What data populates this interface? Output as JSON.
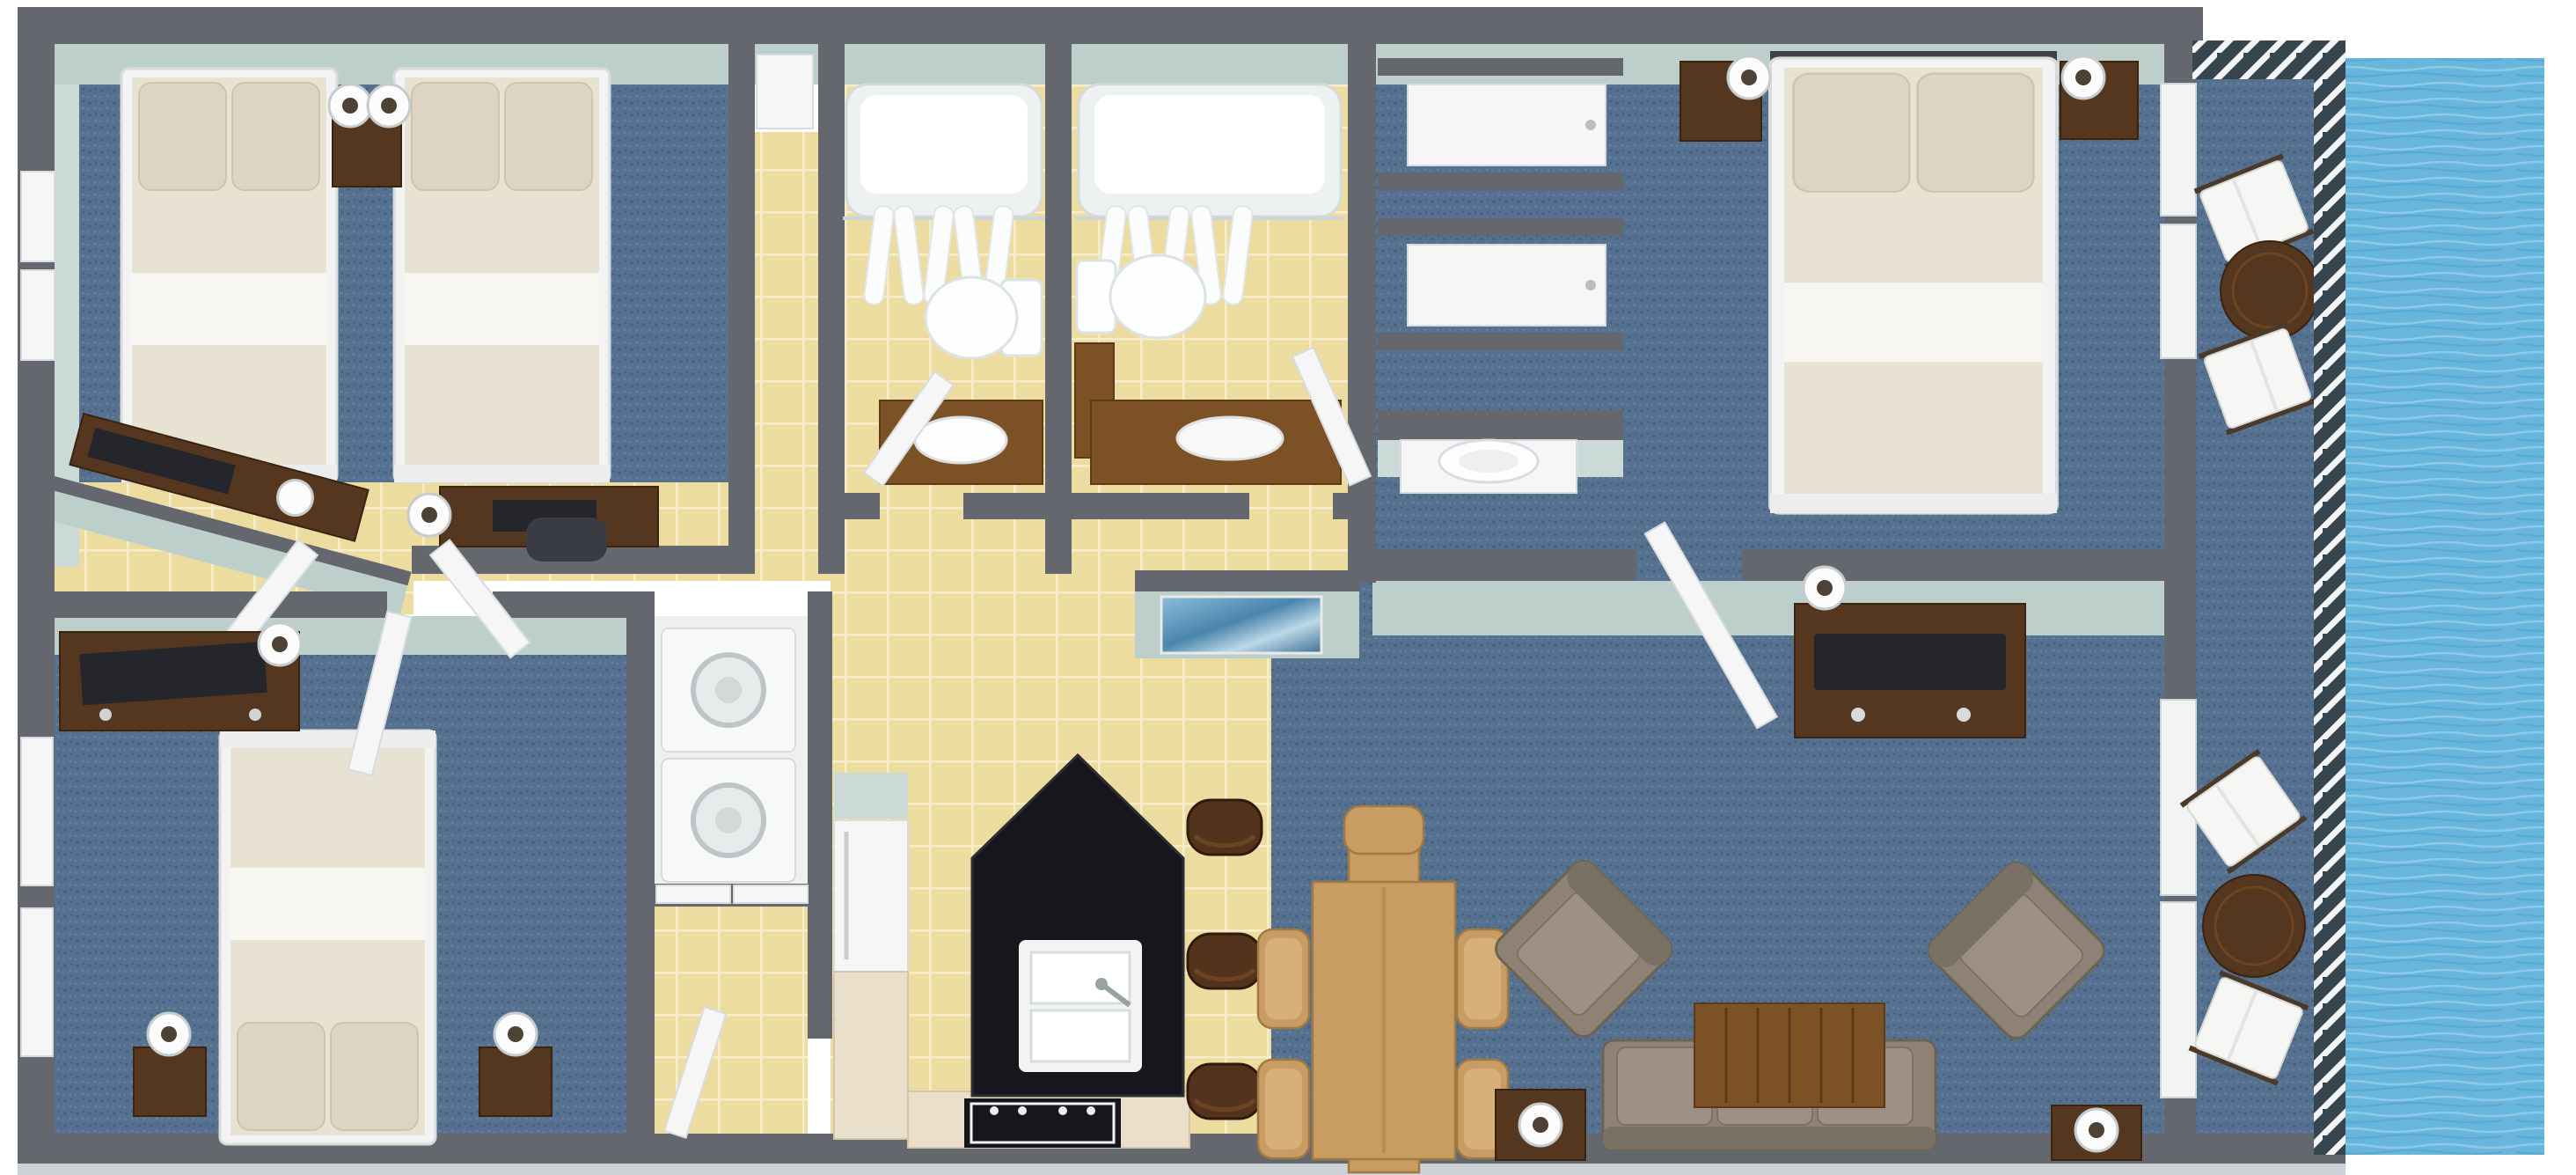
{
  "palette": {
    "wall": "#64676d",
    "outer-band": "#ccd1d6",
    "wall-face": "#bccfcb",
    "wall-face-2": "#cbdad6",
    "carpet": "#55718f",
    "carpet-dark": "#47607d",
    "carpet-light": "#66809e",
    "tile": "#ecdc9f",
    "tile-grid": "#f6eecb",
    "water": "#68b6dc",
    "water-light": "#97d0ea",
    "water-dark": "#54a6d0",
    "railing": "#37454f",
    "wood-dark": "#55361f",
    "wood-mid": "#7d5126",
    "wood-light": "#c89c63",
    "cabinet": "#e9dfcb",
    "counter-black": "#15171c",
    "white-furn": "#f5f6f5",
    "glass-white": "#f2f4f4",
    "mattress": "#e8e2d3",
    "pillow": "#ddd5c1",
    "fold": "#f7f6f1",
    "sofa": "#8e8275",
    "cushion": "#9c9184",
    "sofa-back": "#7b7064",
    "tv": "#24262c",
    "chair-dark": "#393c42"
  },
  "floorplan": {
    "view": "3d-top-down-floor-plan",
    "waterfront_side": "right",
    "rooms": [
      {
        "id": "bedroom-top-left",
        "floor": "blue-carpet",
        "furniture": [
          "double-bed",
          "double-bed",
          "nightstand",
          "table-lamp",
          "table-lamp",
          "angled-console-with-tv",
          "desk",
          "monitor",
          "office-chair",
          "cylinder-lamp",
          "window",
          "window",
          "double-door"
        ]
      },
      {
        "id": "bathroom-left",
        "floor": "yellow-tile",
        "furniture": [
          "bathtub",
          "shower-curtain",
          "curtain-rod",
          "toilet",
          "wood-vanity",
          "door"
        ]
      },
      {
        "id": "bathroom-right",
        "floor": "yellow-tile",
        "furniture": [
          "bathtub",
          "shower-curtain",
          "curtain-rod",
          "toilet",
          "wood-vanity-side",
          "wood-vanity-sink",
          "door"
        ]
      },
      {
        "id": "hallway",
        "floor": "yellow-tile",
        "features": [
          "wall-art-blue"
        ]
      },
      {
        "id": "closet-corridor",
        "furniture": [
          "sliding-door-closet",
          "sliding-door-closet"
        ]
      },
      {
        "id": "wet-bar-nook",
        "furniture": [
          "white-console",
          "round-basin"
        ]
      },
      {
        "id": "master-bedroom",
        "floor": "blue-carpet",
        "furniture": [
          "king-bed",
          "nightstand",
          "nightstand",
          "table-lamp",
          "table-lamp",
          "dresser-with-tv",
          "table-lamp",
          "sliding-glass-door",
          "door"
        ]
      },
      {
        "id": "bedroom-bottom-left",
        "floor": "blue-carpet",
        "furniture": [
          "queen-bed",
          "nightstand",
          "nightstand",
          "table-lamp",
          "table-lamp",
          "dresser-with-tv",
          "window",
          "window",
          "door"
        ]
      },
      {
        "id": "laundry-closet",
        "furniture": [
          "washer",
          "dryer",
          "bifold-doors"
        ]
      },
      {
        "id": "entry-corridor",
        "floor": "yellow-tile",
        "furniture": [
          "entry-door"
        ]
      },
      {
        "id": "kitchen",
        "floor": "yellow-tile",
        "furniture": [
          "black-granite-island",
          "double-sink",
          "faucet",
          "bar-stool",
          "bar-stool",
          "bar-stool",
          "refrigerator",
          "stove",
          "base-cabinets",
          "side-cabinets",
          "counter"
        ]
      },
      {
        "id": "dining-area",
        "floor": "blue-carpet",
        "furniture": [
          "dining-table",
          "dining-chair",
          "dining-chair",
          "dining-chair",
          "dining-chair",
          "dining-chair"
        ]
      },
      {
        "id": "living-room",
        "floor": "blue-carpet",
        "furniture": [
          "sofa",
          "armchair",
          "armchair",
          "coffee-table",
          "side-table",
          "table-lamp",
          "side-table",
          "table-lamp",
          "tv-console",
          "flat-tv",
          "sliding-glass-door"
        ]
      },
      {
        "id": "balcony",
        "floor": "blue-carpet",
        "furniture": [
          "lounge-chair",
          "lounge-chair",
          "round-table",
          "lounge-chair",
          "lounge-chair",
          "round-table"
        ],
        "features": [
          "railing-top",
          "railing-right"
        ]
      },
      {
        "id": "waterfront",
        "features": [
          "ocean-water"
        ]
      }
    ]
  }
}
